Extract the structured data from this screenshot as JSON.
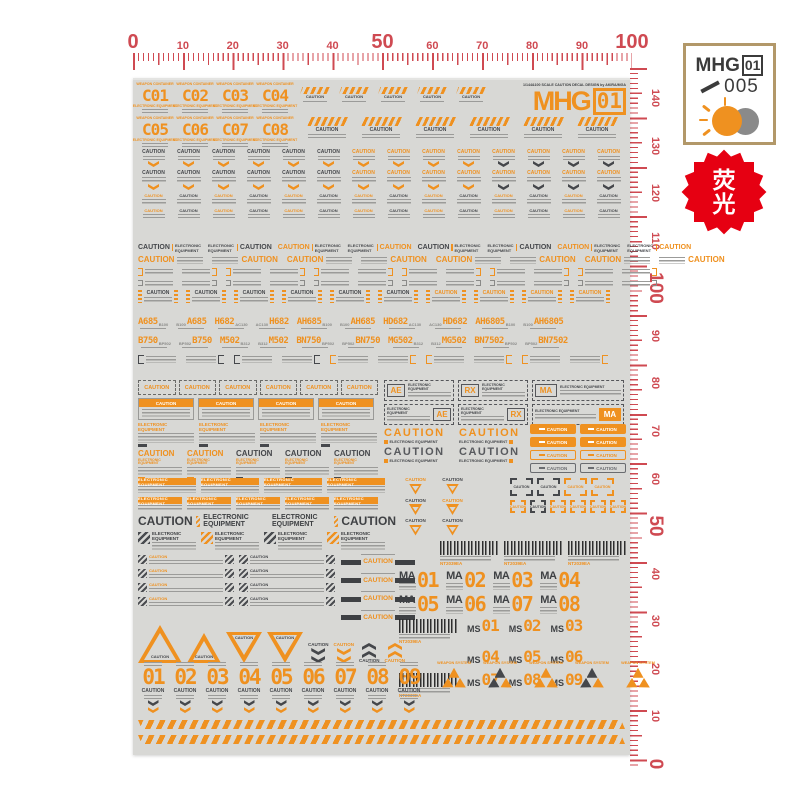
{
  "rulers": {
    "top": {
      "labels": [
        "0",
        "10",
        "20",
        "30",
        "40",
        "50",
        "60",
        "70",
        "80",
        "90",
        "100"
      ]
    },
    "right": {
      "labels": [
        "140",
        "130",
        "120",
        "110",
        "100",
        "90",
        "80",
        "70",
        "60",
        "50",
        "40",
        "30",
        "20",
        "10",
        "0"
      ]
    }
  },
  "brand": {
    "logo": "MHG",
    "number": "01",
    "code": "005"
  },
  "badge": {
    "char1": "荧",
    "char2": "光"
  },
  "sheet": {
    "title": "1/144&100 SCALE CAUTION DECAL DESIGN by AKIRA/MGA",
    "logo": "MHG",
    "logo_number": "01",
    "caution": "CAUTION",
    "electronic_equipment": "ELECTRONIC EQUIPMENT",
    "weapon_container": "WEAPON CONTAINER",
    "weapon_system": "WEAPON SYSTEM",
    "c_row1": [
      "C01",
      "C02",
      "C03",
      "C04"
    ],
    "c_row2": [
      "C05",
      "C06",
      "C07",
      "C08"
    ],
    "code_row1": [
      {
        "main": "A685",
        "sub": "B100"
      },
      {
        "main": "A685",
        "sub": "B100"
      },
      {
        "main": "H682",
        "sub": "AC130"
      },
      {
        "main": "H682",
        "sub": "AC130"
      },
      {
        "main": "AH685",
        "sub": "B100"
      },
      {
        "main": "AH685",
        "sub": "B100"
      },
      {
        "main": "HD682",
        "sub": "AC130"
      },
      {
        "main": "HD682",
        "sub": "AC130"
      },
      {
        "main": "AH6805",
        "sub": "B100"
      },
      {
        "main": "AH6805",
        "sub": "B100"
      }
    ],
    "code_row2": [
      {
        "main": "B750",
        "sub": "BP502"
      },
      {
        "main": "B750",
        "sub": "BP502"
      },
      {
        "main": "M502",
        "sub": "B312"
      },
      {
        "main": "M502",
        "sub": "B312"
      },
      {
        "main": "BN750",
        "sub": "BP502"
      },
      {
        "main": "BN750",
        "sub": "BP502"
      },
      {
        "main": "MG502",
        "sub": "B312"
      },
      {
        "main": "MG502",
        "sub": "B312"
      },
      {
        "main": "BN7502",
        "sub": "BP502"
      },
      {
        "main": "BN7502",
        "sub": "BP502"
      }
    ],
    "units_row1": [
      "AE",
      "RX"
    ],
    "units_row2": [
      "AE",
      "RX"
    ],
    "unit_ma": "MA",
    "ma_label": "MA",
    "ms_label": "MS",
    "ma_row1": [
      "01",
      "02",
      "03",
      "04"
    ],
    "ma_row2": [
      "05",
      "06",
      "07",
      "08"
    ],
    "ms_row1": [
      "01",
      "02",
      "03"
    ],
    "ms_row2": [
      "04",
      "05",
      "06"
    ],
    "ms_row3": [
      "07",
      "08",
      "09"
    ],
    "barcode_code": "NT2039EA",
    "stencil": [
      "01",
      "02",
      "03",
      "04",
      "05",
      "06",
      "07",
      "08",
      "09"
    ]
  },
  "counts": {
    "stripe_sm": 5,
    "stripe_lg": 6,
    "mini": 14,
    "ees": 8,
    "ocs": 8,
    "tsa": 12,
    "tsb": 12,
    "sbr": 10,
    "cbr": 10,
    "dash": 6,
    "hdr": 4,
    "ep": 4,
    "kp": 5,
    "pills": 8,
    "eb1": 4,
    "eb2": 5,
    "hz": 4,
    "hm": 8,
    "black": 4,
    "td": 6,
    "csq_lg": 4,
    "csq_sm": 6,
    "bc_sm": 3,
    "ws": 5
  },
  "colors": {
    "orange": "#ef9120",
    "dark_gray": "#45474b",
    "ruler_red": "#cf4a52",
    "badge_red": "#e60012",
    "sheet_bg": "#d8d8d5",
    "border_tan": "#b29869"
  }
}
